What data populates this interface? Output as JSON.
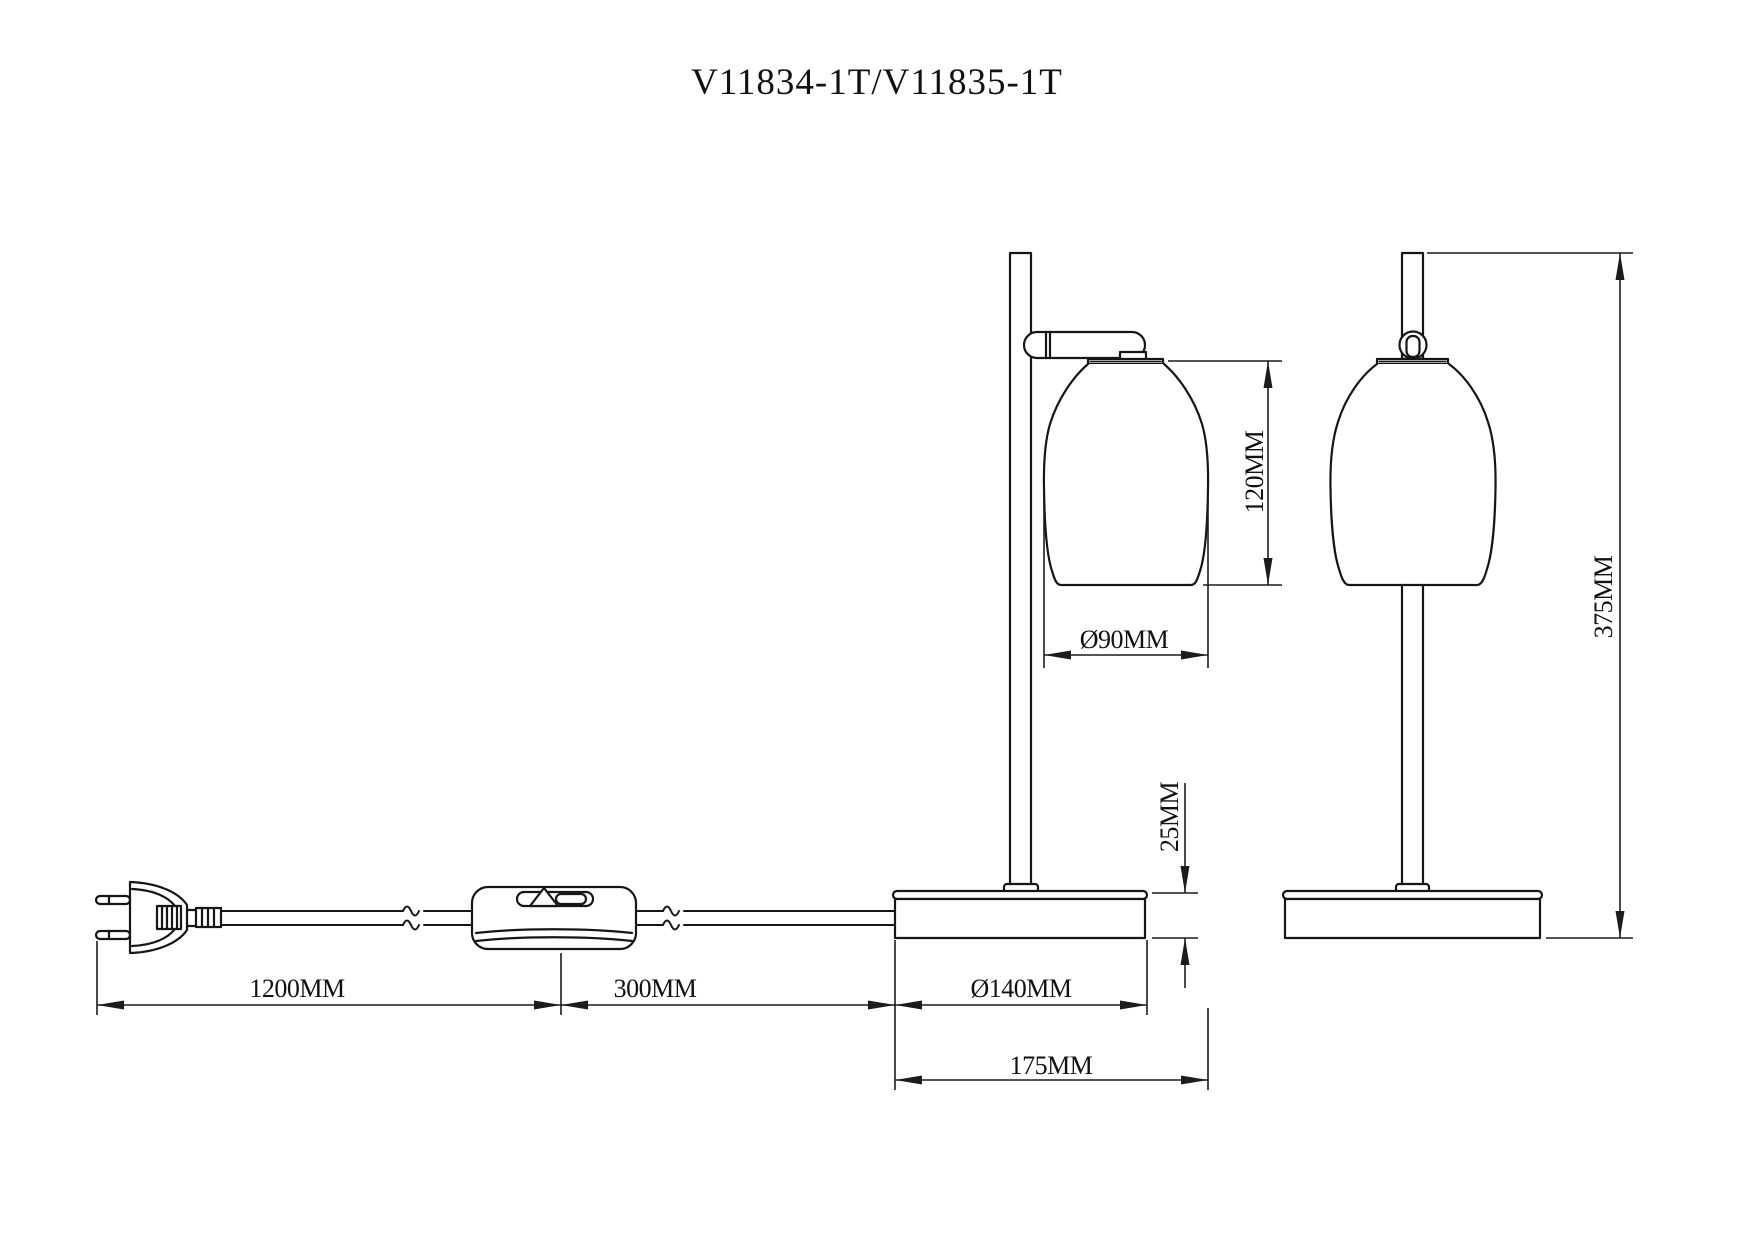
{
  "title": "V11834-1T/V11835-1T",
  "colors": {
    "line": "#161616",
    "background": "#ffffff"
  },
  "dimensions": {
    "shade_height": {
      "label": "120MM",
      "value_mm": 120
    },
    "shade_diameter": {
      "label": "Ø90MM",
      "value_mm": 90
    },
    "base_height": {
      "label": "25MM",
      "value_mm": 25
    },
    "base_diameter": {
      "label": "Ø140MM",
      "value_mm": 140
    },
    "overall_depth": {
      "label": "175MM",
      "value_mm": 175
    },
    "cord_plug_to_switch": {
      "label": "1200MM",
      "value_mm": 1200
    },
    "cord_switch_to_lamp": {
      "label": "300MM",
      "value_mm": 300
    },
    "overall_height": {
      "label": "375MM",
      "value_mm": 375
    }
  }
}
